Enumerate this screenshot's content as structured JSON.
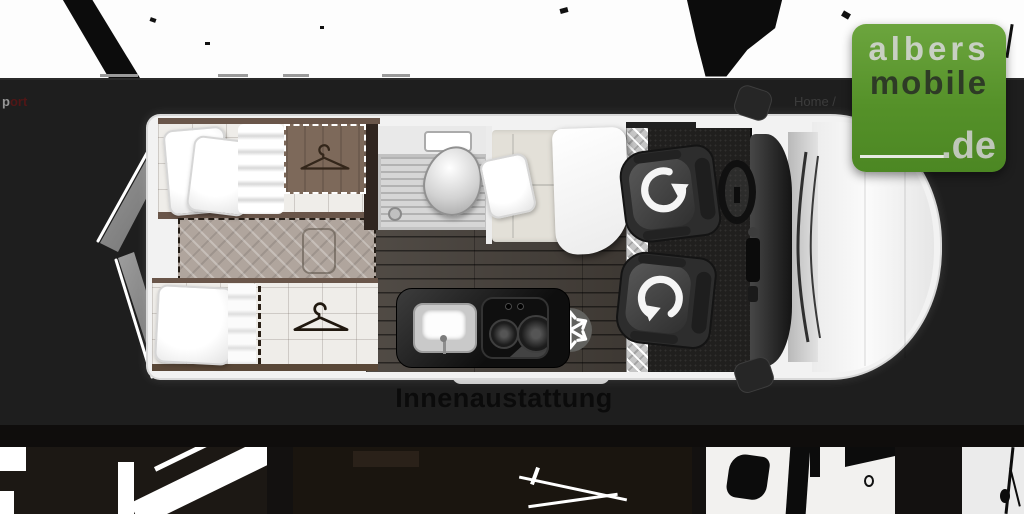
{
  "window": {
    "width": 1024,
    "height": 514
  },
  "header": {
    "left_fragment": {
      "light": "p",
      "dark": "ort",
      "dark_color": "#511616"
    },
    "breadcrumb": {
      "home": "Home /"
    }
  },
  "logo": {
    "line1": "albers",
    "line2": "mobile",
    "line3": ".de",
    "colors": {
      "background": "#559129",
      "line1": "#c8d0c3",
      "line2": "#2e3b26",
      "line3": "#bfc7b9",
      "underline": "#e7eae2"
    }
  },
  "floorplan": {
    "caption": "Innenaustattung",
    "caption_color": "#0b0b0b",
    "features": [
      "rear-double-doors",
      "single-bed-upper",
      "single-bed-lower",
      "wardrobe-with-hanger",
      "center-filler-cushion",
      "shower-tray",
      "toilet",
      "washbasin",
      "bench-seat",
      "table",
      "kitchen-sink",
      "two-burner-hob",
      "fridge-location",
      "entry-step",
      "swivel-seat-front",
      "swivel-seat-rear",
      "steering-wheel",
      "dashboard",
      "windshield",
      "side-mirrors"
    ],
    "icons": [
      "hanger-icon",
      "hanger-icon",
      "snowflake-icon",
      "swivel-arrow-icon",
      "swivel-arrow-icon"
    ]
  },
  "gallery": {
    "thumbnail_count": 4
  }
}
